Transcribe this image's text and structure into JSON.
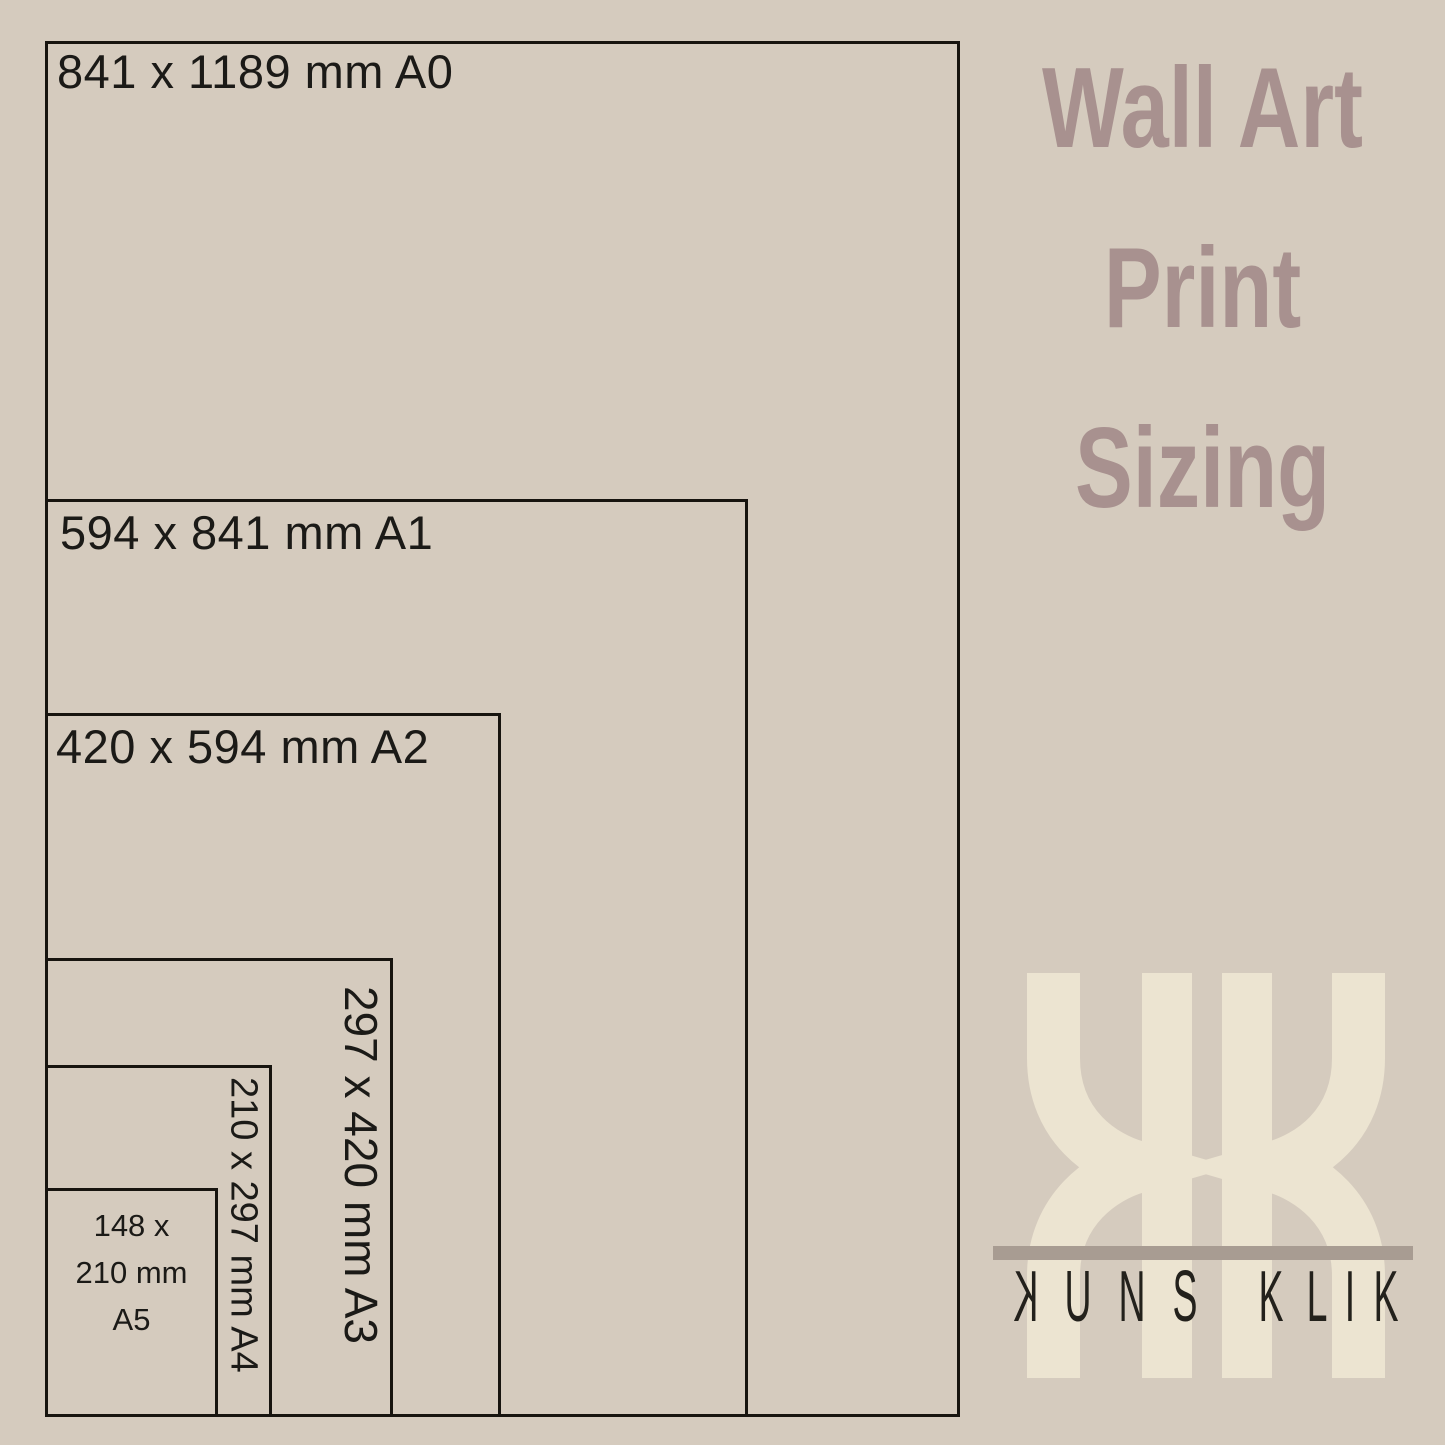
{
  "page": {
    "bg_color": "#d5cbbe",
    "outline_color": "#17140f"
  },
  "title": {
    "line1": "Wall Art",
    "line2": "Print",
    "line3": "Sizing",
    "color": "#a8918f"
  },
  "diagram": {
    "sizes": [
      {
        "code": "A0",
        "label": "841 x 1189 mm A0"
      },
      {
        "code": "A1",
        "label": "594 x 841 mm A1"
      },
      {
        "code": "A2",
        "label": "420 x 594 mm A2"
      },
      {
        "code": "A3",
        "label": "297 x 420 mm A3"
      },
      {
        "code": "A4",
        "label": "210 x 297 mm A4"
      },
      {
        "code": "A5",
        "label": "148 x 210 mm A5",
        "lines": [
          "148 x",
          "210 mm",
          "A5"
        ]
      }
    ]
  },
  "logo": {
    "monogram": "KK",
    "brand": "KUNS KLIK",
    "letters": [
      "K",
      "U",
      "N",
      "S",
      "K",
      "L",
      "I",
      "K"
    ],
    "cream_color": "#ece4d1",
    "line_color": "#a89c92",
    "text_color": "#23211c"
  }
}
